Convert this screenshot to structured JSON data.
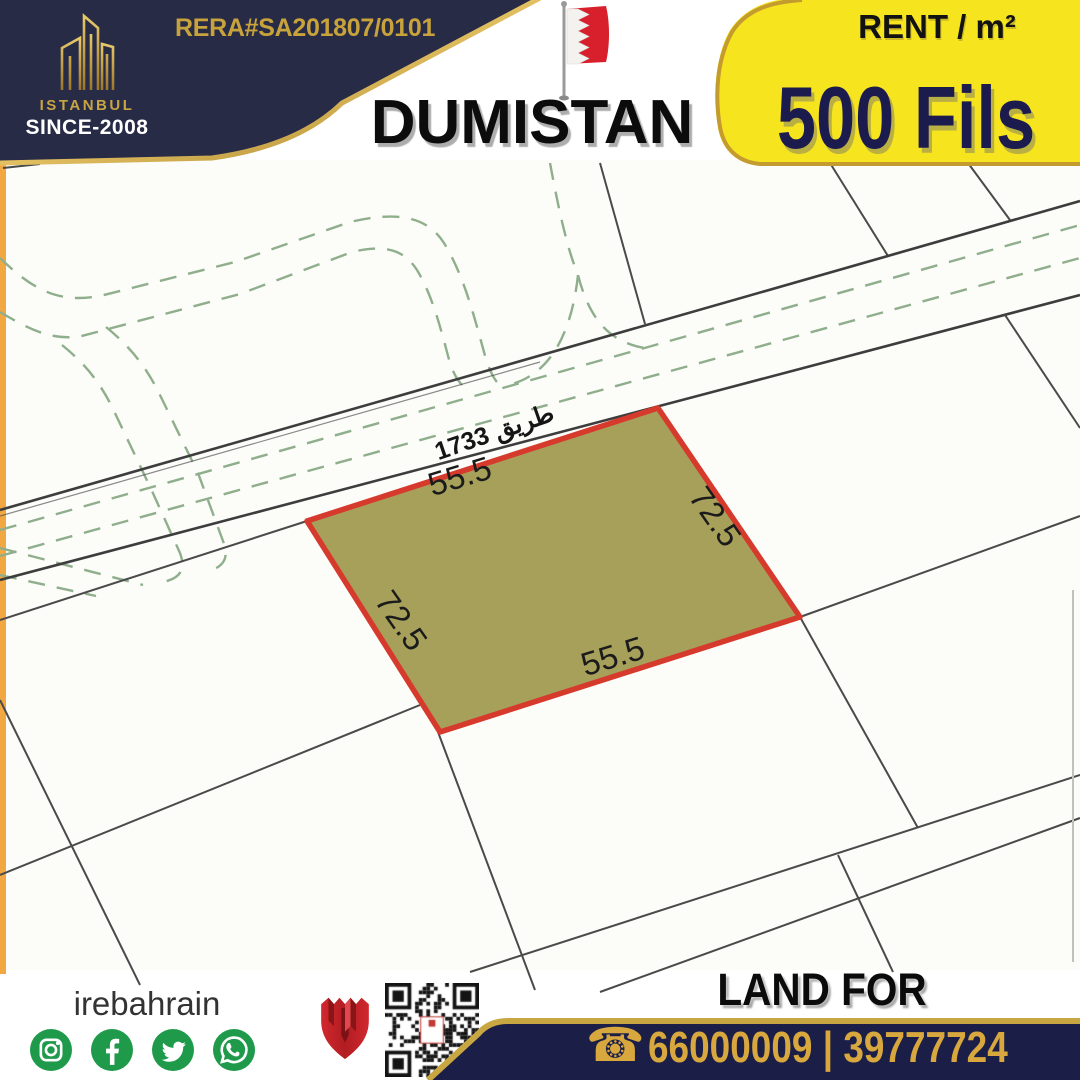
{
  "header": {
    "rera_number": "RERA#SA201807/0101",
    "brand_name": "ISTANBUL",
    "brand_since": "SINCE-2008",
    "brand_logo_icon": "gold-buildings-icon",
    "flag_icon": "bahrain-flag-icon",
    "location_title": "DUMISTAN",
    "price_label": "RENT / m²",
    "price_value": "500 Fils"
  },
  "map": {
    "road_label": "طريق 1733",
    "plot_dimensions": {
      "top": "55.5",
      "right": "72.5",
      "bottom": "55.5",
      "left": "72.5"
    }
  },
  "footer": {
    "social_handle": "irebahrain",
    "social_icons": [
      "instagram-icon",
      "facebook-icon",
      "twitter-icon",
      "whatsapp-icon"
    ],
    "agency_logo_icon": "red-shield-icon",
    "qr_icon": "qr-code",
    "listing_title": "LAND FOR LEASING",
    "phone_icon": "telephone-icon",
    "phone_numbers": "66000009 | 39777724"
  },
  "colors": {
    "header_navy": "#282b46",
    "gold": "#c9a23c",
    "banner_yellow": "#f6e41f",
    "price_navy": "#1b1b4e",
    "plot_fill": "#a7a05a",
    "plot_border": "#d63a2c",
    "dash_green": "#8fae8c",
    "social_green": "#1f9a4b",
    "phone_gold": "#d8a83e",
    "footer_navy": "#1b1f48"
  }
}
